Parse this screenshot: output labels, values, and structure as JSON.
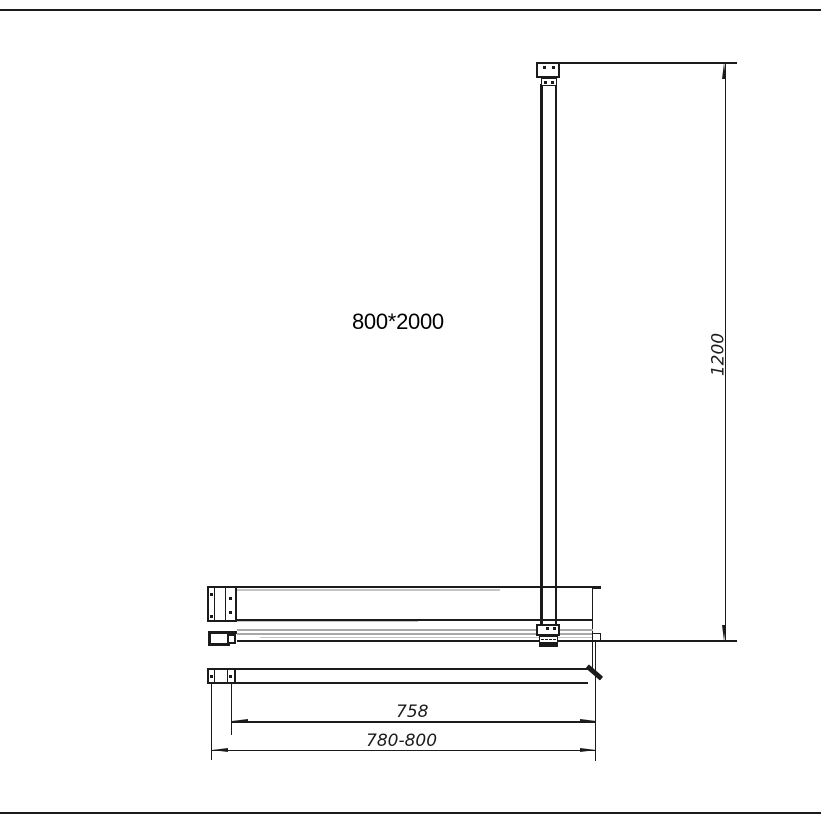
{
  "drawing": {
    "size_label": "800*2000",
    "dimensions": {
      "support_bar_length": "1200",
      "glass_panel_width": "758",
      "adjustable_width_range": "780-800"
    },
    "colors": {
      "line": "#1b1b1b",
      "glass_gray": "#a8a8a8",
      "glass_light_gray": "#c4c4c4",
      "background": "#ffffff"
    }
  }
}
